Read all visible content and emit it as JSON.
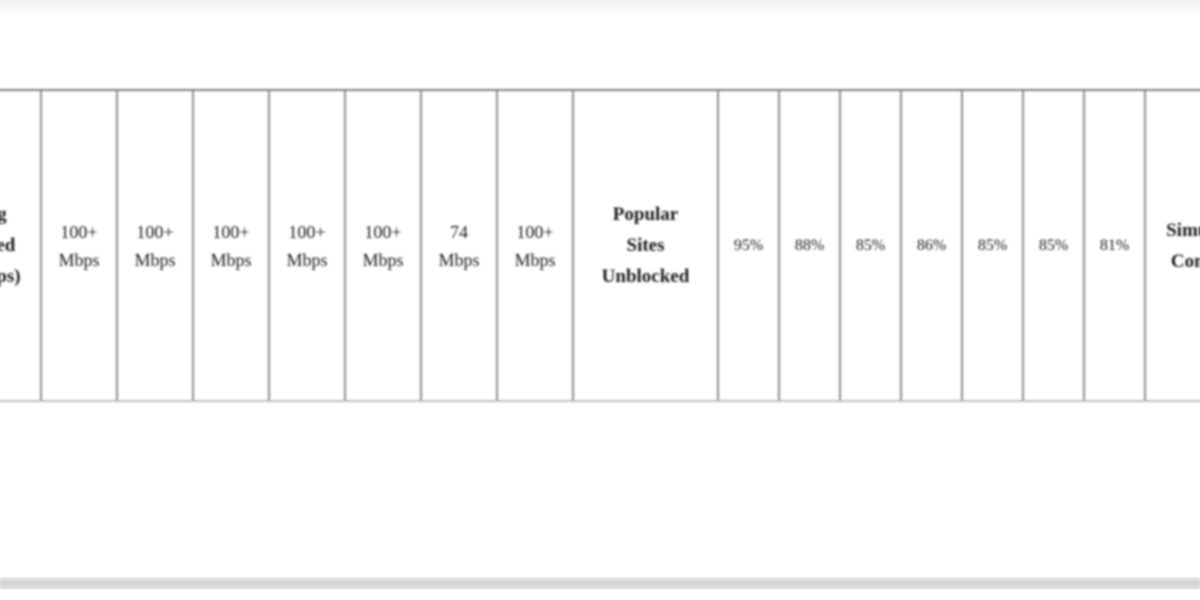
{
  "page": {
    "top_divider": true,
    "bottom_divider": true,
    "colors": {
      "background": "#ffffff",
      "table_border": "#8c8c8c",
      "table_border_top": "#7c7c7c",
      "table_border_bottom": "#bdbdbd",
      "text": "#1b1b1b",
      "top_rule": "#f2f2f2",
      "bottom_rule": "#d4d4d4"
    }
  },
  "table": {
    "description": "Horizontally clipped VPN comparison strip: row headers followed by per-provider values",
    "metrics": [
      {
        "id": "avg_speed",
        "label": "Avg Speed (Mbps)",
        "values": [
          "100+ Mbps",
          "100+ Mbps",
          "100+ Mbps",
          "100+ Mbps",
          "100+ Mbps",
          "74 Mbps",
          "100+ Mbps"
        ]
      },
      {
        "id": "sites_unblocked",
        "label": "Popular Sites Unblocked",
        "values": [
          "95%",
          "88%",
          "85%",
          "86%",
          "85%",
          "85%",
          "81%"
        ]
      },
      {
        "id": "connections",
        "label": "Simultaneous Connections",
        "values": []
      }
    ],
    "cells": [
      {
        "type": "header",
        "pos": "left",
        "metric": "avg_speed",
        "text": "Avg Speed (Mbps)",
        "lines": [
          "Avg",
          "Speed",
          "(Mbps)"
        ],
        "clipped": "left"
      },
      {
        "type": "value",
        "group": "speed",
        "metric": "avg_speed",
        "text": "100+ Mbps",
        "lines": [
          "100+",
          "Mbps"
        ]
      },
      {
        "type": "value",
        "group": "speed",
        "metric": "avg_speed",
        "text": "100+ Mbps",
        "lines": [
          "100+",
          "Mbps"
        ]
      },
      {
        "type": "value",
        "group": "speed",
        "metric": "avg_speed",
        "text": "100+ Mbps",
        "lines": [
          "100+",
          "Mbps"
        ]
      },
      {
        "type": "value",
        "group": "speed",
        "metric": "avg_speed",
        "text": "100+ Mbps",
        "lines": [
          "100+",
          "Mbps"
        ]
      },
      {
        "type": "value",
        "group": "speed",
        "metric": "avg_speed",
        "text": "100+ Mbps",
        "lines": [
          "100+",
          "Mbps"
        ]
      },
      {
        "type": "value",
        "group": "speed",
        "metric": "avg_speed",
        "text": "74 Mbps",
        "lines": [
          "74",
          "Mbps"
        ]
      },
      {
        "type": "value",
        "group": "speed",
        "metric": "avg_speed",
        "text": "100+ Mbps",
        "lines": [
          "100+",
          "Mbps"
        ]
      },
      {
        "type": "header",
        "pos": "mid",
        "metric": "sites_unblocked",
        "text": "Popular Sites Unblocked",
        "lines": [
          "Popular",
          "Sites",
          "Unblocked"
        ]
      },
      {
        "type": "value",
        "group": "pct",
        "metric": "sites_unblocked",
        "text": "95%",
        "lines": [
          "95%"
        ]
      },
      {
        "type": "value",
        "group": "pct",
        "metric": "sites_unblocked",
        "text": "88%",
        "lines": [
          "88%"
        ]
      },
      {
        "type": "value",
        "group": "pct",
        "metric": "sites_unblocked",
        "text": "85%",
        "lines": [
          "85%"
        ]
      },
      {
        "type": "value",
        "group": "pct",
        "metric": "sites_unblocked",
        "text": "86%",
        "lines": [
          "86%"
        ]
      },
      {
        "type": "value",
        "group": "pct",
        "metric": "sites_unblocked",
        "text": "85%",
        "lines": [
          "85%"
        ]
      },
      {
        "type": "value",
        "group": "pct",
        "metric": "sites_unblocked",
        "text": "85%",
        "lines": [
          "85%"
        ]
      },
      {
        "type": "value",
        "group": "pct",
        "metric": "sites_unblocked",
        "text": "81%",
        "lines": [
          "81%"
        ]
      },
      {
        "type": "header",
        "pos": "right",
        "metric": "connections",
        "text": "Simultaneous Connections",
        "lines": [
          "Simultaneous",
          "Connections"
        ],
        "clipped": "right"
      }
    ]
  }
}
